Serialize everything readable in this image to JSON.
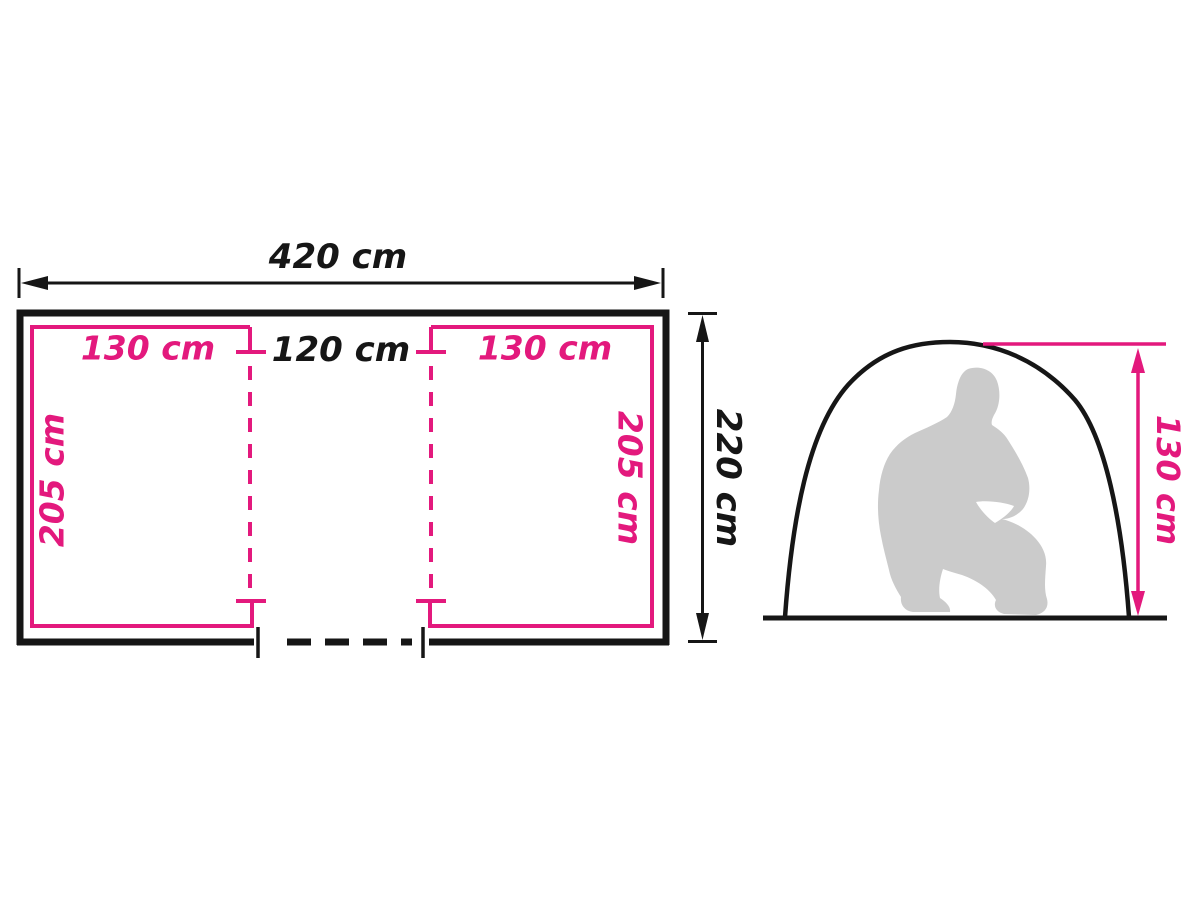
{
  "title": "Tent dimensions diagram",
  "colors": {
    "accent_pink": "#E3197D",
    "line_black": "#161616",
    "silhouette_gray": "#CBCBCB"
  },
  "floor_plan": {
    "total_width": "420 cm",
    "total_depth": "220 cm",
    "center_width": "120 cm",
    "left_cabin": {
      "width": "130 cm",
      "depth": "205 cm"
    },
    "right_cabin": {
      "width": "130 cm",
      "depth": "205 cm"
    }
  },
  "side_view": {
    "inner_height": "130 cm"
  }
}
